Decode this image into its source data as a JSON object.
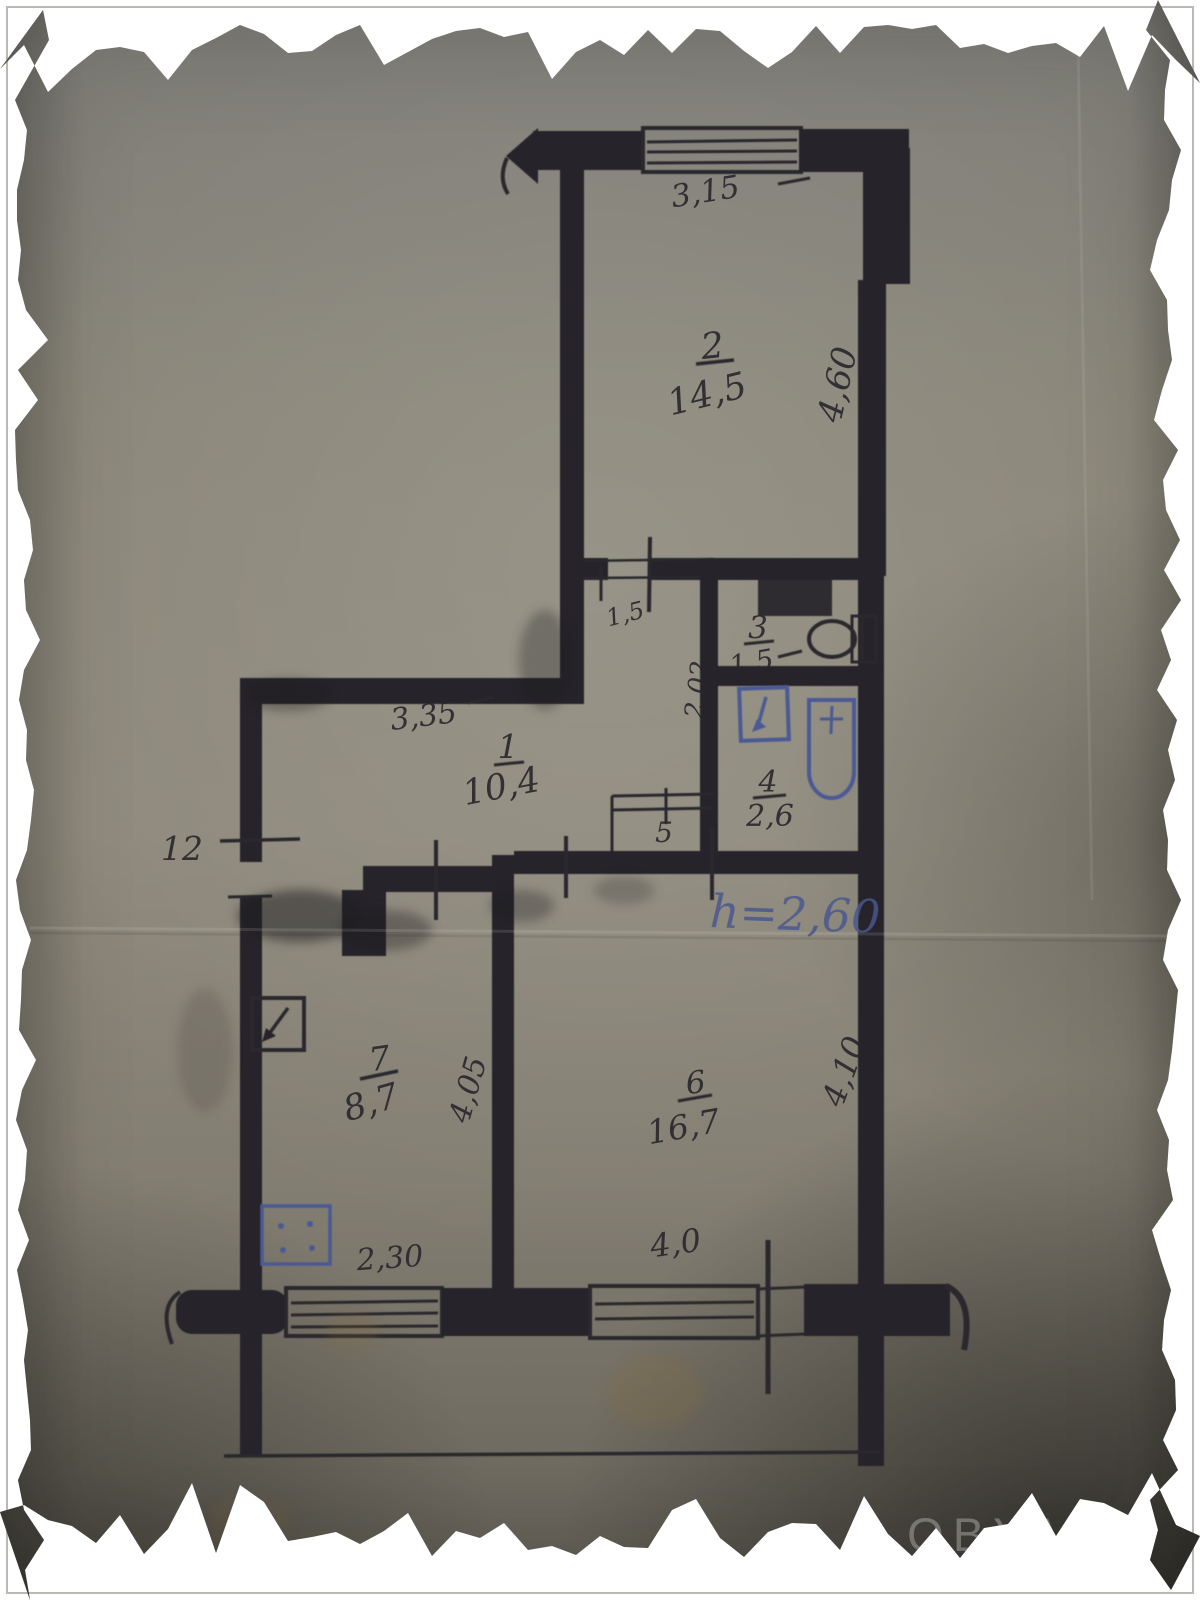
{
  "watermark": "OBYAVA",
  "colors": {
    "ink": "#26242a",
    "blue_ink": "#4b5a94",
    "paper": "#8a8679"
  },
  "plan": {
    "rooms": {
      "room1": {
        "number": "1",
        "area": "10,4"
      },
      "room2": {
        "number": "2",
        "area": "14,5"
      },
      "room3": {
        "number": "3",
        "area": "1,5"
      },
      "room4": {
        "number": "4",
        "area": "2,6"
      },
      "room5": {
        "number": "5"
      },
      "room6": {
        "number": "6",
        "area": "16,7"
      },
      "room7": {
        "number": "7",
        "area": "8,7"
      }
    },
    "dimensions": {
      "room2_window": "3,15",
      "room2_side": "4,60",
      "hall_width": "3,35",
      "hall_door": "1,5",
      "bath_side": "2,02",
      "left_note": "12",
      "kitchen_side": "4,05",
      "room6_side": "4,10",
      "kitchen_window": "2,30",
      "room6_window": "4,0"
    },
    "notes": {
      "ceiling_height": "h=2,60"
    }
  }
}
